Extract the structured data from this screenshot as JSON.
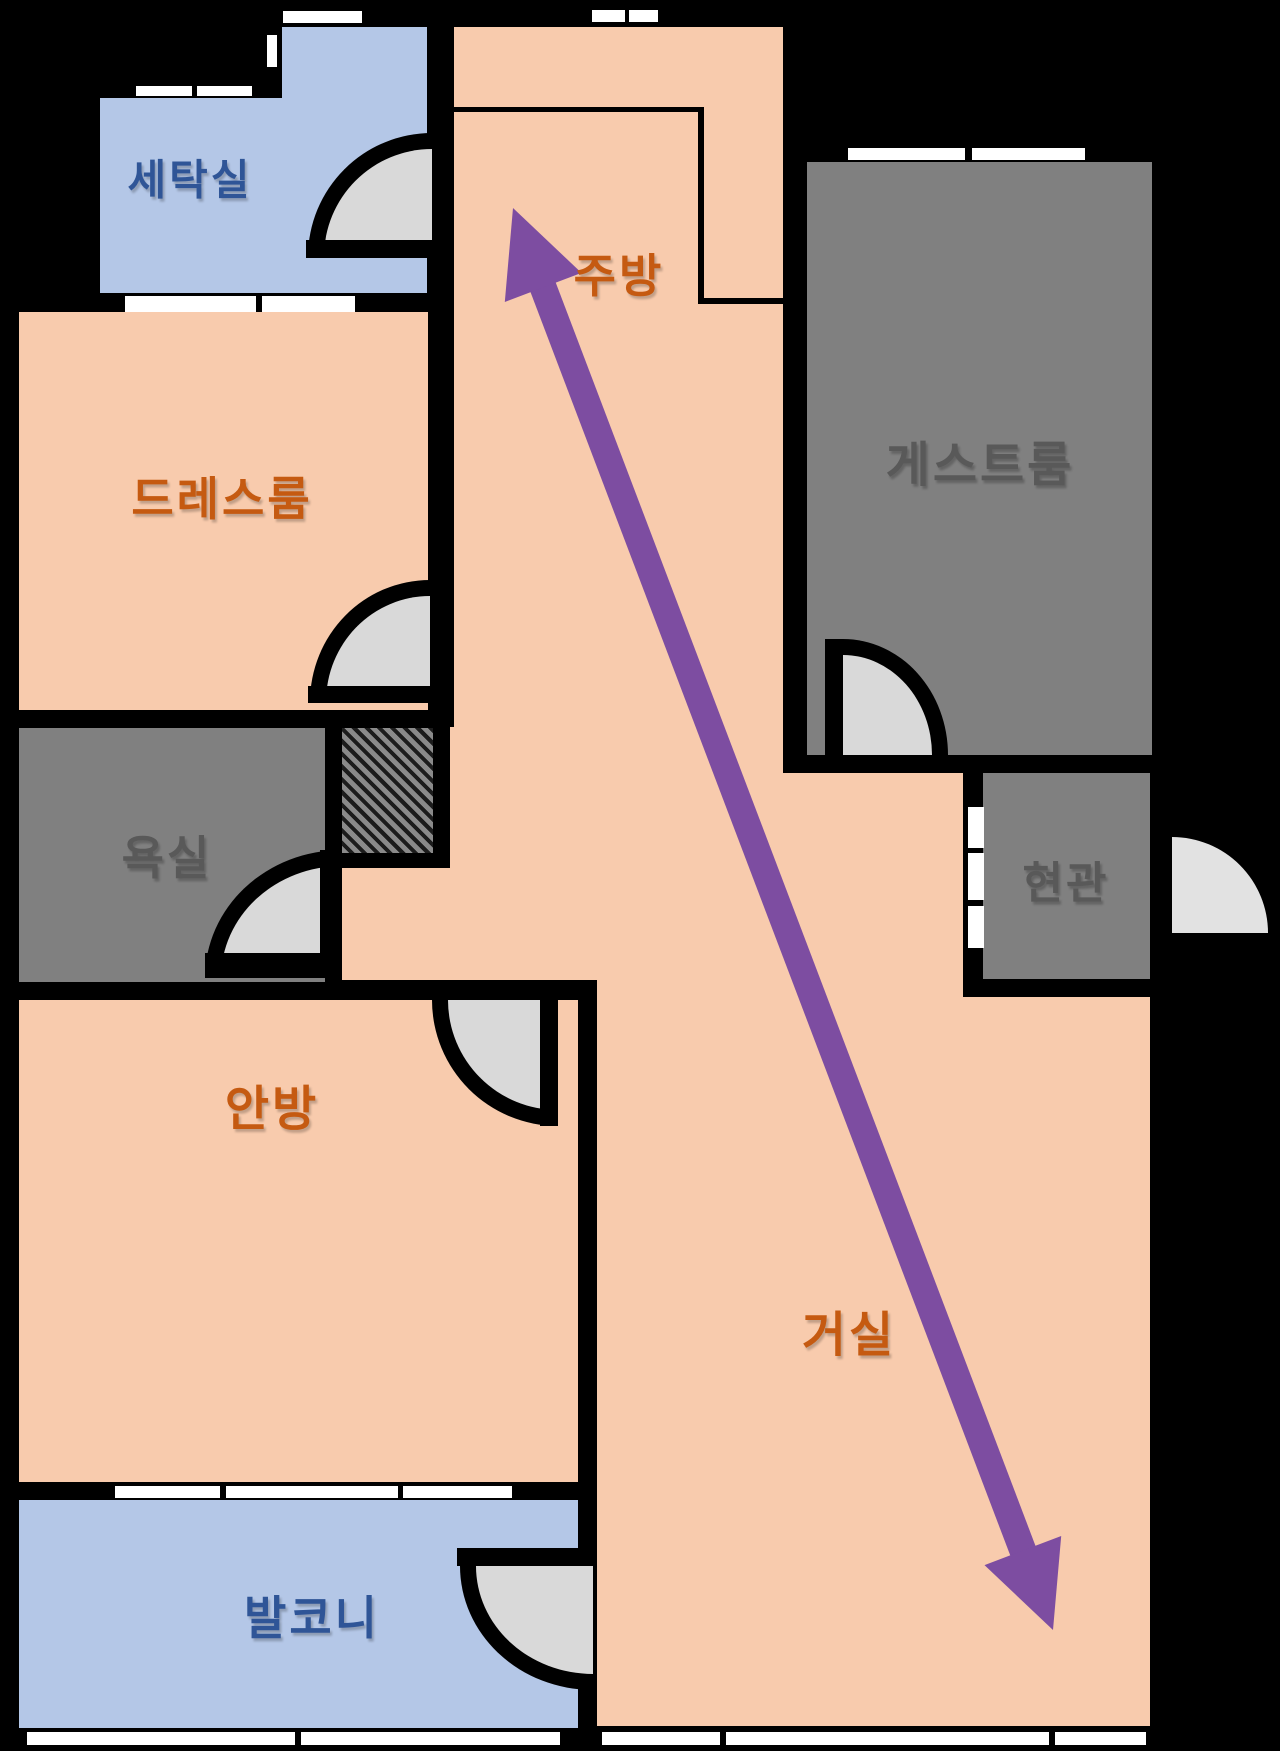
{
  "title": "apartment-floor-plan",
  "colors": {
    "background": "#000000",
    "room_peach": "#f8cbad",
    "room_blue": "#b4c7e7",
    "room_gray": "#808080",
    "door_disc": "#d9d9d9",
    "door_disc_exterior": "#e2e2e2",
    "window_white": "#ffffff",
    "wall_black": "#000000",
    "label_orange": "#c55a11",
    "label_blue": "#2f5597",
    "label_gray": "#595959",
    "arrow_purple": "#7d4da1"
  },
  "rooms": [
    {
      "id": "laundry",
      "label": "세탁실",
      "fill": "room_blue",
      "label_color": "label_blue",
      "label_px": 42,
      "label_pos": [
        190,
        177
      ],
      "rects": [
        [
          100,
          98,
          327,
          195
        ],
        [
          282,
          27,
          145,
          266
        ]
      ]
    },
    {
      "id": "dressroom",
      "label": "드레스룸",
      "fill": "room_peach",
      "label_color": "label_orange",
      "label_px": 46,
      "label_pos": [
        222,
        496
      ],
      "rects": [
        [
          19,
          312,
          409,
          398
        ]
      ]
    },
    {
      "id": "bathroom",
      "label": "욕실",
      "fill": "room_gray",
      "label_color": "label_gray",
      "label_px": 46,
      "label_pos": [
        167,
        855
      ],
      "rects": [
        [
          19,
          728,
          306,
          254
        ]
      ]
    },
    {
      "id": "master-bedroom",
      "label": "안방",
      "fill": "room_peach",
      "label_color": "label_orange",
      "label_px": 48,
      "label_pos": [
        272,
        1104
      ],
      "rects": [
        [
          19,
          1000,
          559,
          482
        ]
      ]
    },
    {
      "id": "balcony",
      "label": "발코니",
      "fill": "room_blue",
      "label_color": "label_blue",
      "label_px": 46,
      "label_pos": [
        312,
        1615
      ],
      "rects": [
        [
          19,
          1500,
          559,
          228
        ]
      ]
    },
    {
      "id": "kitchen",
      "label": "주방",
      "fill": "room_peach",
      "label_color": "label_orange",
      "label_px": 46,
      "label_pos": [
        619,
        273
      ],
      "rects": [
        [
          454,
          27,
          329,
          746
        ],
        [
          448,
          727,
          335,
          133
        ],
        [
          342,
          853,
          441,
          127
        ]
      ]
    },
    {
      "id": "living-room",
      "label": "거실",
      "fill": "room_peach",
      "label_color": "label_orange",
      "label_px": 48,
      "label_pos": [
        849,
        1330
      ],
      "rects": [
        [
          597,
          773,
          366,
          953
        ],
        [
          963,
          997,
          187,
          729
        ]
      ]
    },
    {
      "id": "guest-room",
      "label": "게스트룸",
      "fill": "room_gray",
      "label_color": "label_gray",
      "label_px": 48,
      "label_pos": [
        980,
        460
      ],
      "rects": [
        [
          807,
          162,
          345,
          593
        ]
      ]
    },
    {
      "id": "entrance",
      "label": "현관",
      "fill": "room_gray",
      "label_color": "label_gray",
      "label_px": 44,
      "label_pos": [
        1066,
        879
      ],
      "rects": [
        [
          983,
          773,
          167,
          206
        ]
      ]
    }
  ],
  "windows": [
    {
      "id": "laundry-top-window",
      "rect": [
        283,
        11,
        79,
        12
      ]
    },
    {
      "id": "laundry-side-window",
      "rect": [
        267,
        35,
        10,
        32
      ]
    },
    {
      "id": "laundry-left-window-a",
      "rect": [
        136,
        86,
        56,
        10
      ]
    },
    {
      "id": "laundry-left-window-b",
      "rect": [
        197,
        86,
        55,
        10
      ]
    },
    {
      "id": "laundry-bottom-window-a",
      "rect": [
        125,
        296,
        131,
        16
      ]
    },
    {
      "id": "laundry-bottom-window-b",
      "rect": [
        262,
        296,
        93,
        16
      ]
    },
    {
      "id": "kitchen-top-window-a",
      "rect": [
        592,
        10,
        33,
        12
      ]
    },
    {
      "id": "kitchen-top-window-b",
      "rect": [
        629,
        10,
        29,
        12
      ]
    },
    {
      "id": "guest-room-top-window-a",
      "rect": [
        848,
        148,
        117,
        12
      ]
    },
    {
      "id": "guest-room-top-window-b",
      "rect": [
        972,
        148,
        113,
        12
      ]
    },
    {
      "id": "bedroom-balcony-window-a",
      "rect": [
        115,
        1486,
        105,
        12
      ]
    },
    {
      "id": "bedroom-balcony-window-b",
      "rect": [
        226,
        1486,
        172,
        12
      ]
    },
    {
      "id": "bedroom-balcony-window-c",
      "rect": [
        403,
        1486,
        109,
        12
      ]
    },
    {
      "id": "entrance-side-panel-a",
      "rect": [
        968,
        807,
        16,
        41
      ]
    },
    {
      "id": "entrance-side-panel-b",
      "rect": [
        968,
        853,
        16,
        47
      ]
    },
    {
      "id": "entrance-side-panel-c",
      "rect": [
        968,
        906,
        16,
        42
      ]
    },
    {
      "id": "balcony-bottom-window-a",
      "rect": [
        27,
        1732,
        268,
        13
      ]
    },
    {
      "id": "balcony-bottom-window-b",
      "rect": [
        301,
        1732,
        259,
        13
      ]
    },
    {
      "id": "living-bottom-window-a",
      "rect": [
        602,
        1732,
        118,
        13
      ]
    },
    {
      "id": "living-bottom-window-b",
      "rect": [
        726,
        1732,
        323,
        13
      ]
    },
    {
      "id": "living-bottom-window-c",
      "rect": [
        1055,
        1732,
        91,
        13
      ]
    }
  ],
  "doors": [
    {
      "id": "laundry-door",
      "box": [
        308,
        133,
        124,
        124
      ],
      "corner": "tl",
      "border": 16,
      "outlined": true,
      "disc": "door_disc",
      "leaves": [
        [
          306,
          240,
          130,
          18
        ]
      ]
    },
    {
      "id": "dressroom-door",
      "box": [
        310,
        580,
        120,
        122
      ],
      "corner": "tl",
      "border": 16,
      "outlined": true,
      "disc": "door_disc",
      "leaves": [
        [
          308,
          686,
          126,
          17
        ]
      ]
    },
    {
      "id": "bathroom-door",
      "box": [
        205,
        850,
        137,
        128
      ],
      "corner": "tl",
      "border": 16,
      "outlined": true,
      "disc": "door_disc",
      "leaves": [
        [
          320,
          850,
          22,
          128
        ],
        [
          205,
          953,
          137,
          25
        ]
      ]
    },
    {
      "id": "bedroom-door",
      "box": [
        432,
        1000,
        126,
        126
      ],
      "corner": "bl",
      "border": 16,
      "outlined": true,
      "disc": "door_disc",
      "leaves": [
        [
          540,
          1000,
          18,
          126
        ]
      ]
    },
    {
      "id": "balcony-door",
      "box": [
        460,
        1566,
        133,
        124
      ],
      "corner": "bl",
      "border": 16,
      "outlined": true,
      "disc": "door_disc",
      "leaves": [
        [
          457,
          1548,
          136,
          18
        ]
      ]
    },
    {
      "id": "guest-room-door",
      "box": [
        843,
        639,
        105,
        116
      ],
      "corner": "tr",
      "border": 16,
      "outlined": true,
      "disc": "door_disc",
      "leaves": [
        [
          825,
          639,
          18,
          116
        ]
      ]
    },
    {
      "id": "entrance-door",
      "box": [
        1172,
        837,
        96,
        96
      ],
      "corner": "tr",
      "border": 0,
      "outlined": false,
      "disc": "door_disc_exterior",
      "leaves": []
    }
  ],
  "hatch_shaft": {
    "id": "duct-shaft",
    "frame": [
      325,
      712,
      125,
      156
    ],
    "fill": [
      342,
      728,
      91,
      125
    ]
  },
  "kitchen_counter_lines": [
    [
      454,
      107,
      246,
      5
    ],
    [
      698,
      107,
      6,
      196
    ],
    [
      698,
      298,
      85,
      6
    ]
  ],
  "flow_arrow": {
    "id": "kitchen-to-living-arrow",
    "x1": 513,
    "y1": 208,
    "x2": 1053,
    "y2": 1630,
    "shaft_width": 27,
    "head_length": 85,
    "head_half_width": 41
  }
}
